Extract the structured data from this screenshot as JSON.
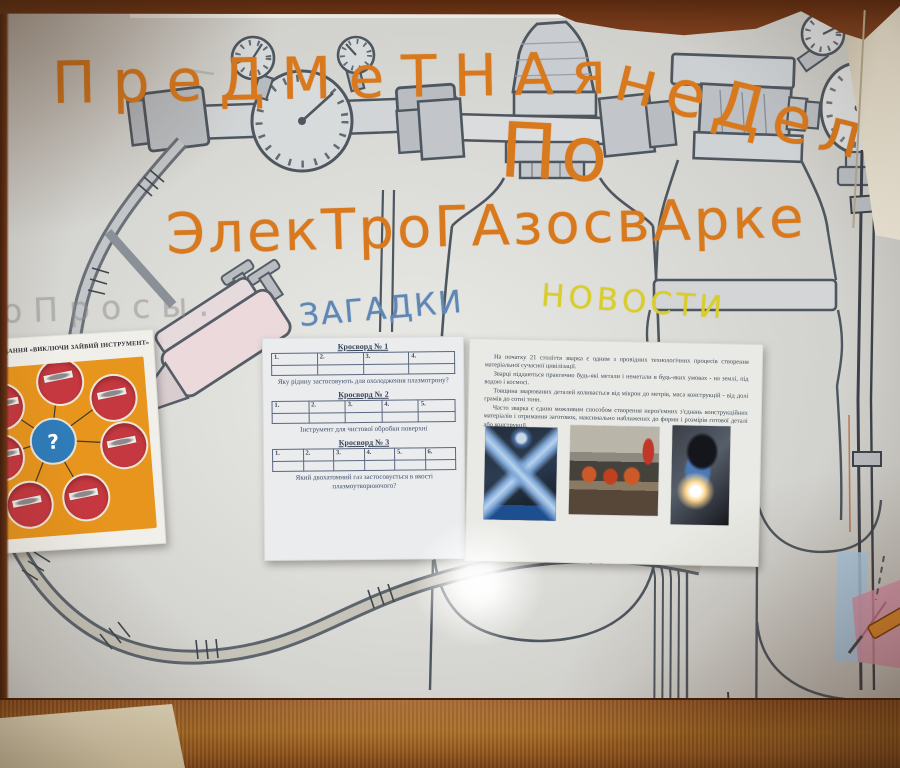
{
  "poster": {
    "title_word1": "ПреДМеТНАя",
    "title_word2": "неДеля",
    "title_preposition": "По",
    "title_line2": "ЭлекТроГАзосвАрке",
    "section_polls_faint": "оПросы.",
    "section_riddles": "ЗАГАДКИ",
    "section_news": "НОВОСТИ",
    "colors": {
      "marker_orange": "#d8791e",
      "marker_blue": "#5e87b5",
      "marker_yellow": "#d9cd2e",
      "pencil_gray": "#5a626b"
    }
  },
  "task_sheet": {
    "title": "ЗАВДАННЯ «ВИКЛЮЧИ ЗАЙВИЙ ІНСТРУМЕНТ»",
    "center_symbol": "?",
    "circle_count": 7,
    "label_strips_legible": false,
    "colors": {
      "panel": "#e8951d",
      "circle": "#c63840",
      "center": "#2f7cba"
    }
  },
  "crossword_sheet": {
    "items": [
      {
        "title": "Кросворд № 1",
        "cells": [
          "1.",
          "2.",
          "3.",
          "4."
        ],
        "question": "Яку рідину застосовують для охолодження плазмотрону?"
      },
      {
        "title": "Кросворд № 2",
        "cells": [
          "1.",
          "2.",
          "3.",
          "4.",
          "5."
        ],
        "question": "Інструмент для чистової обробки поверхні"
      },
      {
        "title": "Кросворд № 3",
        "cells": [
          "1.",
          "2.",
          "3.",
          "4.",
          "5.",
          "6."
        ],
        "question": "Який двохатомний газ застосовується в якості плазмоутворюючого?"
      }
    ]
  },
  "news_sheet": {
    "paragraphs": [
      "На початку 21 століття зварка є одним з провідних технологічних процесів створення матеріальної сучасної цивілізації.",
      "Зварці піддаються практично будь-які метали і неметали в будь-яких умовах - на землі, під водою і космосі.",
      "Товщина зварюваних деталей коливається від мікрон до метрів, маса конструкцій - від долі грамів до сотні тонн.",
      "Часто зварка є єдино можливим способом створення нероз'ємних з'єднань конструкційних матеріалів і отримання заготовок, максимально наближених до форми і розмірів готової деталі або конструкції."
    ],
    "photo_count": 3
  }
}
